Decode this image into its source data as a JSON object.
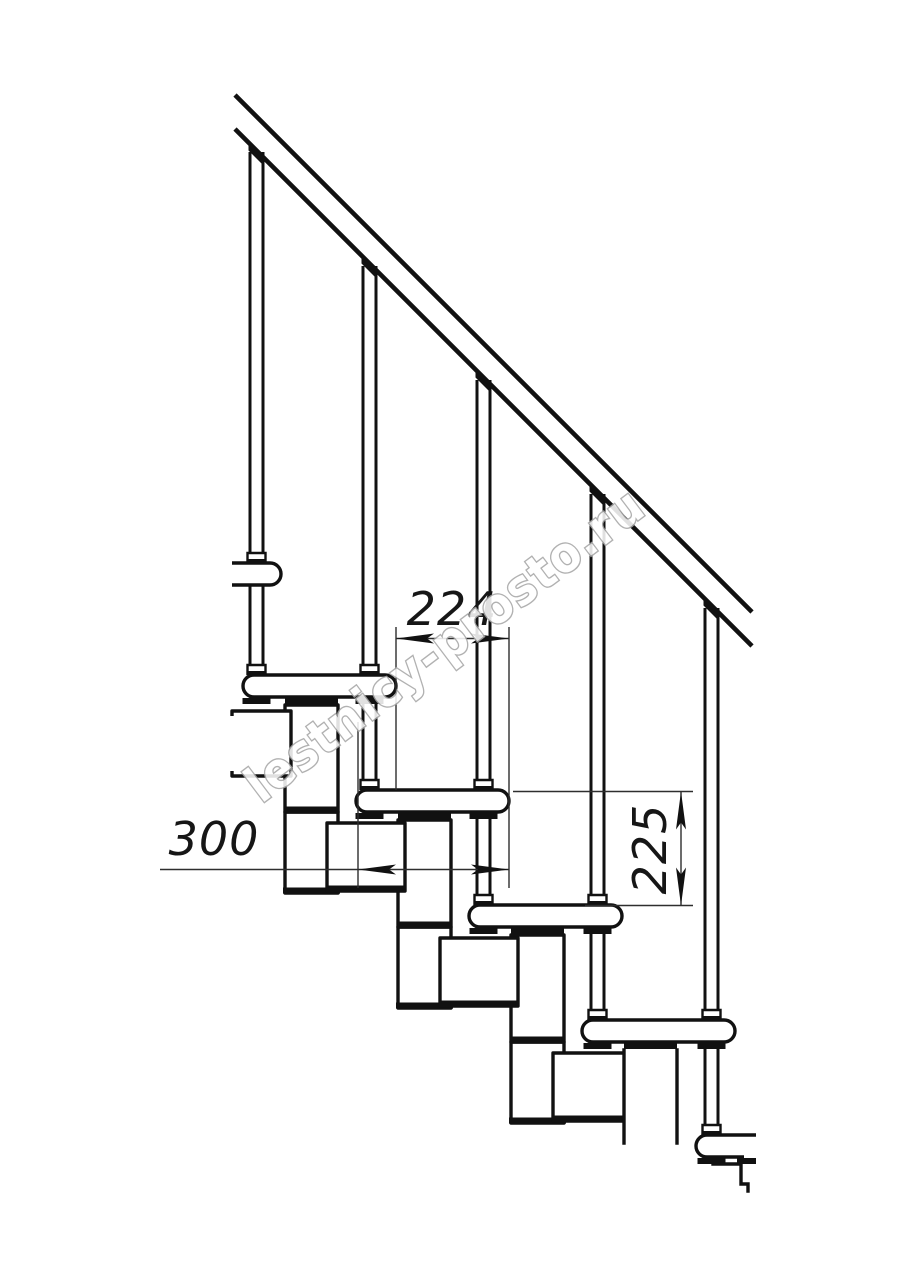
{
  "page": {
    "background": "#ffffff"
  },
  "drawing": {
    "line_color": "#111111",
    "dim_color": "#2e2e2e",
    "dimensions": {
      "tread_run": {
        "value": "224"
      },
      "tread_depth": {
        "value": "300"
      },
      "step_rise": {
        "value": "225"
      }
    },
    "watermark": {
      "text": "lestnicy-prosto.ru",
      "fill": "#ffffff",
      "stroke": "#a6a6a6"
    }
  }
}
